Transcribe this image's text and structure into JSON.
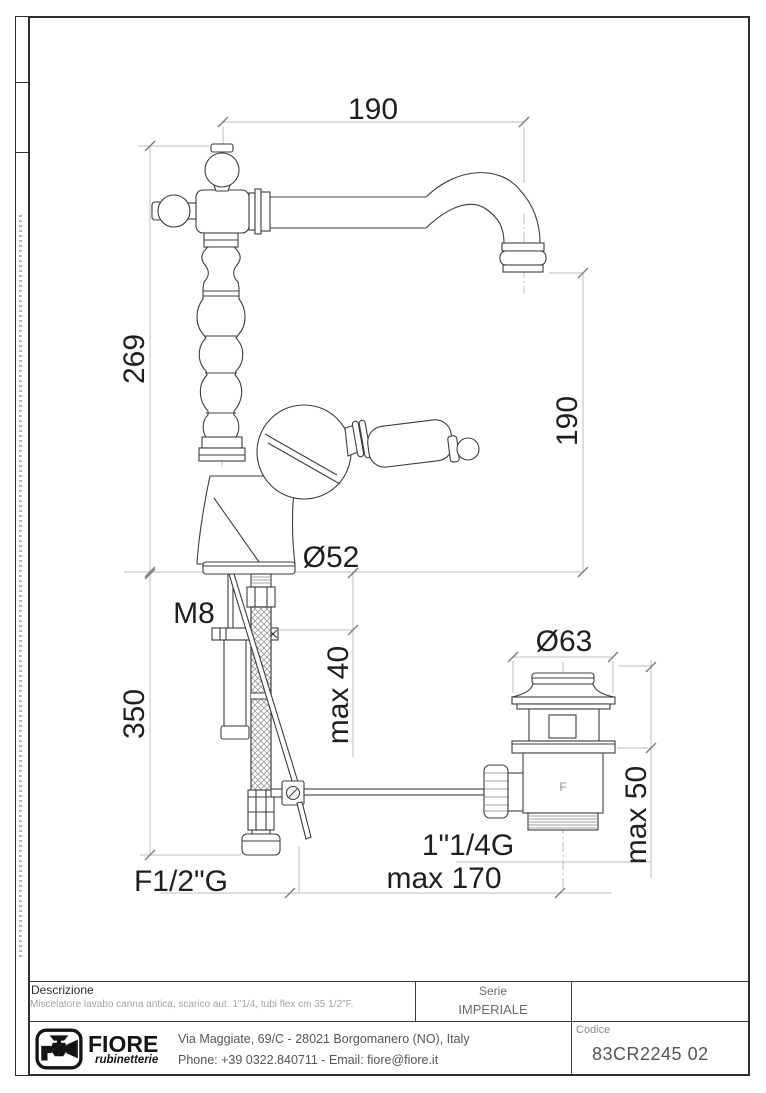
{
  "dims": {
    "spout_reach": "190",
    "total_height": "269",
    "outlet_height": "190",
    "base_diameter": "Ø52",
    "stud_thread": "M8",
    "deck_thickness": "max 40",
    "hose_length": "350",
    "waste_flange_diameter": "Ø63",
    "waste_clamp": "max 50",
    "waste_thread": "1\"1/4G",
    "rod_reach": "max 170",
    "hose_thread": "F1/2\"G",
    "waste_mark": "F"
  },
  "title_block": {
    "descrizione_label": "Descrizione",
    "descrizione_text": "Miscelatore lavabo canna antica, scarico aut. 1\"1/4, tubi flex cm 35 1/2\"F.",
    "serie_label": "Serie",
    "serie_value": "IMPERIALE",
    "codice_label": "Codice",
    "codice_value": "83CR2245 02",
    "address_line1": "Via Maggiate, 69/C - 28021 Borgomanero (NO), Italy",
    "address_line2": "Phone: +39 0322.840711 - Email: fiore@fiore.it"
  },
  "logo": {
    "name": "FIORE",
    "tagline": "rubinetterie"
  }
}
